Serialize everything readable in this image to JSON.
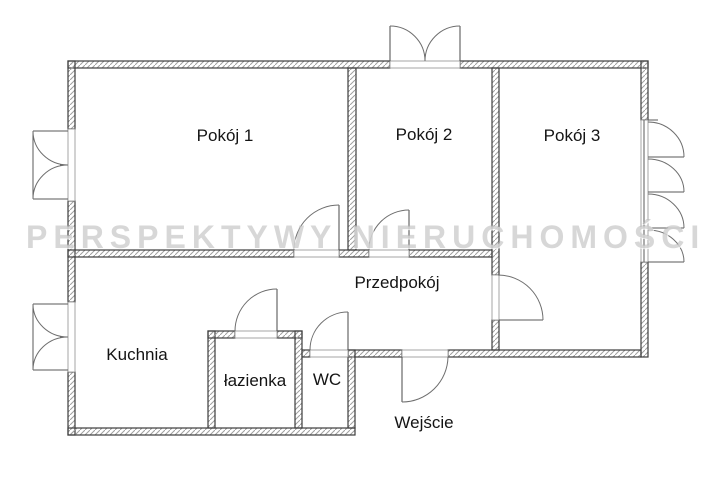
{
  "watermark_text": "PERSPEKTYWY NIERUCHOMOŚCI",
  "rooms": {
    "pokoj1": "Pokój 1",
    "pokoj2": "Pokój 2",
    "pokoj3": "Pokój 3",
    "przedpokoj": "Przedpokój",
    "kuchnia": "Kuchnia",
    "lazienka": "łazienka",
    "wc": "WC"
  },
  "entrance_label": "Wejście",
  "colors": {
    "background": "#ffffff",
    "wall_line": "#3c3c3c",
    "wall_hatch": "#a0a0a0",
    "label_text": "#141414",
    "watermark": "#b6b6b6"
  }
}
